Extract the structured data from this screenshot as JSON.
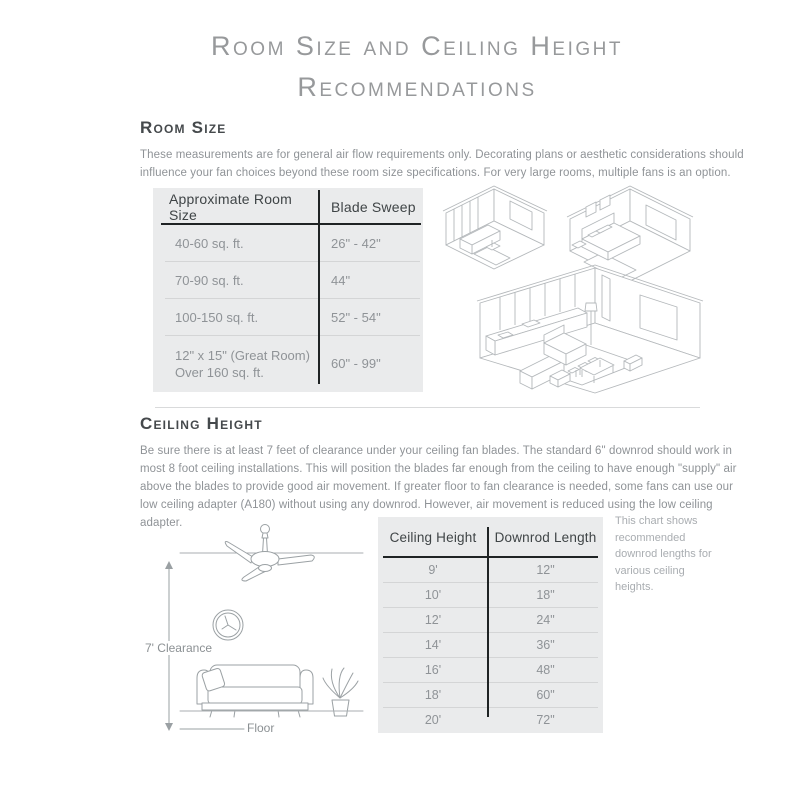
{
  "header": {
    "title_line1": "Room Size and Ceiling Height",
    "title_line2": "Recommendations"
  },
  "room_size": {
    "heading": "Room Size",
    "description": "These measurements are for general air flow requirements only. Decorating plans or aesthetic considerations should influence your fan choices beyond these room size specifications. For very large rooms, multiple fans is an option.",
    "table": {
      "columns": [
        "Approximate Room Size",
        "Blade Sweep"
      ],
      "rows": [
        [
          "40-60 sq. ft.",
          "26\" - 42\""
        ],
        [
          "70-90 sq. ft.",
          "44\""
        ],
        [
          "100-150 sq. ft.",
          "52\" - 54\""
        ],
        [
          "12\" x 15\" (Great Room)\nOver 160 sq. ft.",
          "60\" - 99\""
        ]
      ]
    }
  },
  "ceiling_height": {
    "heading": "Ceiling Height",
    "description": "Be sure there is at least 7 feet of clearance under your ceiling fan blades. The standard 6\" downrod should work in most 8 foot ceiling installations. This will position the blades far enough from the ceiling to have enough \"supply\" air above the blades to provide good air movement. If greater floor to fan clearance is needed, some fans can use our low ceiling adapter (A180) without using any downrod. However, air movement is reduced using the low ceiling adapter.",
    "illustration": {
      "clearance_label": "7' Clearance",
      "floor_label": "Floor"
    },
    "table": {
      "columns": [
        "Ceiling Height",
        "Downrod Length"
      ],
      "rows": [
        [
          "9'",
          "12\""
        ],
        [
          "10'",
          "18\""
        ],
        [
          "12'",
          "24\""
        ],
        [
          "14'",
          "36\""
        ],
        [
          "16'",
          "48\""
        ],
        [
          "18'",
          "60\""
        ],
        [
          "20'",
          "72\""
        ]
      ]
    },
    "note": "This chart shows recommended downrod lengths for various ceiling heights."
  },
  "colors": {
    "table_background": "#eaebec",
    "rule_dark": "#1f2324",
    "text_muted": "#8f9397",
    "heading": "#45494c",
    "title": "#97999b",
    "divider": "#d9dadb",
    "row_separator": "#d4d5d6",
    "illustration_stroke": "#b4b8bb"
  }
}
